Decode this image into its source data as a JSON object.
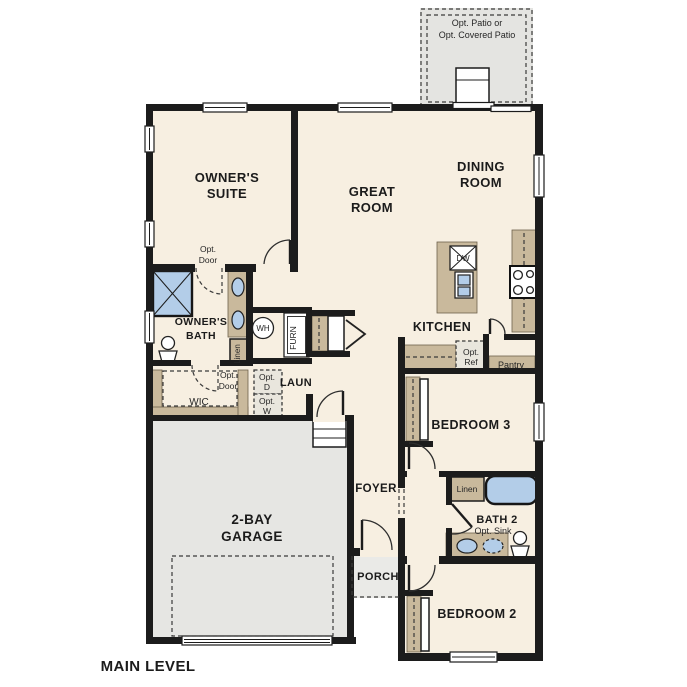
{
  "colors": {
    "wall": "#1c1c1c",
    "floor": "#f7efe1",
    "garage": "#e6e6e3",
    "porch": "#eaeae7",
    "patio": "#e4e4e1",
    "tan": "#c9b99c",
    "blue": "#b3cde8",
    "optbox": "#e9e6dd"
  },
  "plan": {
    "title": "MAIN LEVEL",
    "rooms": {
      "owners_suite": {
        "line1": "OWNER'S",
        "line2": "SUITE"
      },
      "great_room": {
        "line1": "GREAT",
        "line2": "ROOM"
      },
      "dining_room": {
        "line1": "DINING",
        "line2": "ROOM"
      },
      "kitchen": {
        "label": "KITCHEN"
      },
      "owners_bath": {
        "line1": "OWNER'S",
        "line2": "BATH"
      },
      "wic": {
        "label": "WIC"
      },
      "laundry": {
        "label": "LAUN"
      },
      "garage": {
        "line1": "2-BAY",
        "line2": "GARAGE"
      },
      "foyer": {
        "label": "FOYER"
      },
      "porch": {
        "label": "PORCH"
      },
      "bedroom3": {
        "label": "BEDROOM 3"
      },
      "bath2": {
        "label": "BATH 2"
      },
      "bedroom2": {
        "label": "BEDROOM 2"
      }
    },
    "patio": {
      "line1": "Opt. Patio or",
      "line2": "Opt. Covered Patio"
    },
    "fixtures": {
      "wh": "WH",
      "furn": "FURN",
      "dw": "DW",
      "linen_owner": "Linen",
      "linen_hall": "Linen",
      "pantry": "Pantry",
      "opt_door_suite": {
        "line1": "Opt.",
        "line2": "Door"
      },
      "opt_door_wic": {
        "line1": "Opt.",
        "line2": "Door"
      },
      "opt_ref": {
        "line1": "Opt.",
        "line2": "Ref"
      },
      "opt_d": {
        "line1": "Opt.",
        "line2": "D"
      },
      "opt_w": {
        "line1": "Opt.",
        "line2": "W"
      },
      "opt_sink": "Opt. Sink"
    }
  }
}
